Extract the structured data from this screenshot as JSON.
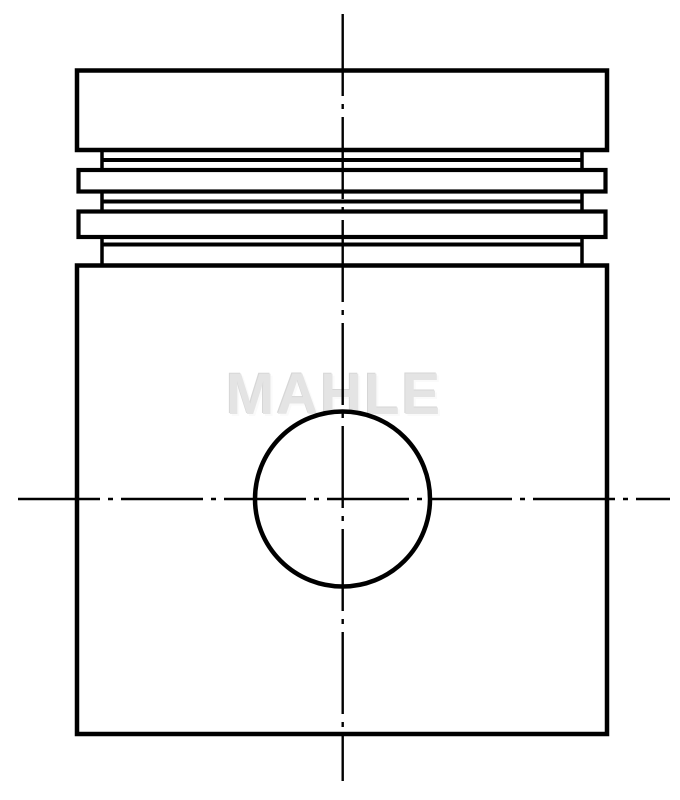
{
  "watermark": {
    "text": "MAHLE",
    "color": "#e4e4e4"
  },
  "drawing": {
    "background": "#ffffff",
    "stroke_color": "#000000",
    "canvas": {
      "width": 680,
      "height": 800
    },
    "shapes": [
      {
        "kind": "rect",
        "name": "piston-crown-outline",
        "x": 77,
        "y": 70.5,
        "w": 530,
        "h": 79.5,
        "sw": 4.5
      },
      {
        "kind": "line",
        "name": "ring-groove-1-wall-left",
        "x1": 102,
        "y1": 150,
        "x2": 102,
        "y2": 170,
        "sw": 3.5
      },
      {
        "kind": "line",
        "name": "ring-groove-1-wall-right",
        "x1": 582,
        "y1": 150,
        "x2": 582,
        "y2": 170,
        "sw": 3.5
      },
      {
        "kind": "line",
        "name": "ring-groove-1-bottom-line",
        "x1": 102,
        "y1": 160,
        "x2": 582,
        "y2": 160,
        "sw": 4
      },
      {
        "kind": "rect",
        "name": "ring-land-1-outline",
        "x": 78.5,
        "y": 170,
        "w": 527,
        "h": 21.5,
        "sw": 4.2
      },
      {
        "kind": "line",
        "name": "ring-groove-2-wall-left",
        "x1": 102,
        "y1": 191.5,
        "x2": 102,
        "y2": 211.5,
        "sw": 3.5
      },
      {
        "kind": "line",
        "name": "ring-groove-2-wall-right",
        "x1": 582,
        "y1": 191.5,
        "x2": 582,
        "y2": 211.5,
        "sw": 3.5
      },
      {
        "kind": "line",
        "name": "ring-groove-2-bottom-line",
        "x1": 102,
        "y1": 201.5,
        "x2": 582,
        "y2": 201.5,
        "sw": 4
      },
      {
        "kind": "rect",
        "name": "ring-land-2-outline",
        "x": 78.5,
        "y": 211.5,
        "w": 527,
        "h": 25.5,
        "sw": 4.2
      },
      {
        "kind": "line",
        "name": "ring-groove-3-wall-left",
        "x1": 102,
        "y1": 237,
        "x2": 102,
        "y2": 265.5,
        "sw": 3.5
      },
      {
        "kind": "line",
        "name": "ring-groove-3-wall-right",
        "x1": 582,
        "y1": 237,
        "x2": 582,
        "y2": 265.5,
        "sw": 3.5
      },
      {
        "kind": "line",
        "name": "ring-groove-3-bottom-line",
        "x1": 102,
        "y1": 244.5,
        "x2": 582,
        "y2": 244.5,
        "sw": 4
      },
      {
        "kind": "rect",
        "name": "piston-skirt-outline",
        "x": 77,
        "y": 265.5,
        "w": 530,
        "h": 468.5,
        "sw": 4.5
      },
      {
        "kind": "circle",
        "name": "pin-bore-circle",
        "cx": 342.5,
        "cy": 499,
        "r": 87.5,
        "sw": 4.5
      },
      {
        "kind": "line",
        "name": "centerline-vertical",
        "x1": 342.7,
        "y1": 14,
        "x2": 342.7,
        "y2": 781,
        "sw": 2.4,
        "dash": "82 8 5 8"
      },
      {
        "kind": "line",
        "name": "centerline-horizontal",
        "x1": 18,
        "y1": 499,
        "x2": 670,
        "y2": 499,
        "sw": 2.4,
        "dash": "82 8 5 8"
      }
    ]
  }
}
